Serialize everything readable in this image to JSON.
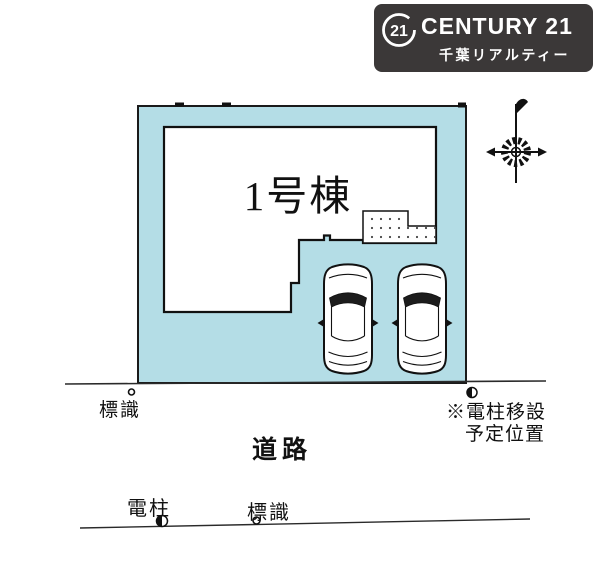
{
  "brand": {
    "mark": "21",
    "name": "CENTURY 21",
    "subtitle": "千葉リアルティー",
    "bg_color": "#3b3838",
    "text_color": "#ffffff"
  },
  "plan": {
    "building_label": "1号棟",
    "lot_fill": "#b4dde6",
    "line_color": "#1a1a1a",
    "labels": {
      "sign_upper": "標識",
      "pole_relocation_line1": "※電柱移設",
      "pole_relocation_line2": "予定位置",
      "road": "道路",
      "pole_lower": "電柱",
      "sign_lower": "標識"
    },
    "symbols": {
      "compass": "compass-rose",
      "sign_marker": "open-circle",
      "pole_marker": "half-filled-circle",
      "cars": "car-top-view x2",
      "porch": "dotted-entrance-area"
    }
  }
}
